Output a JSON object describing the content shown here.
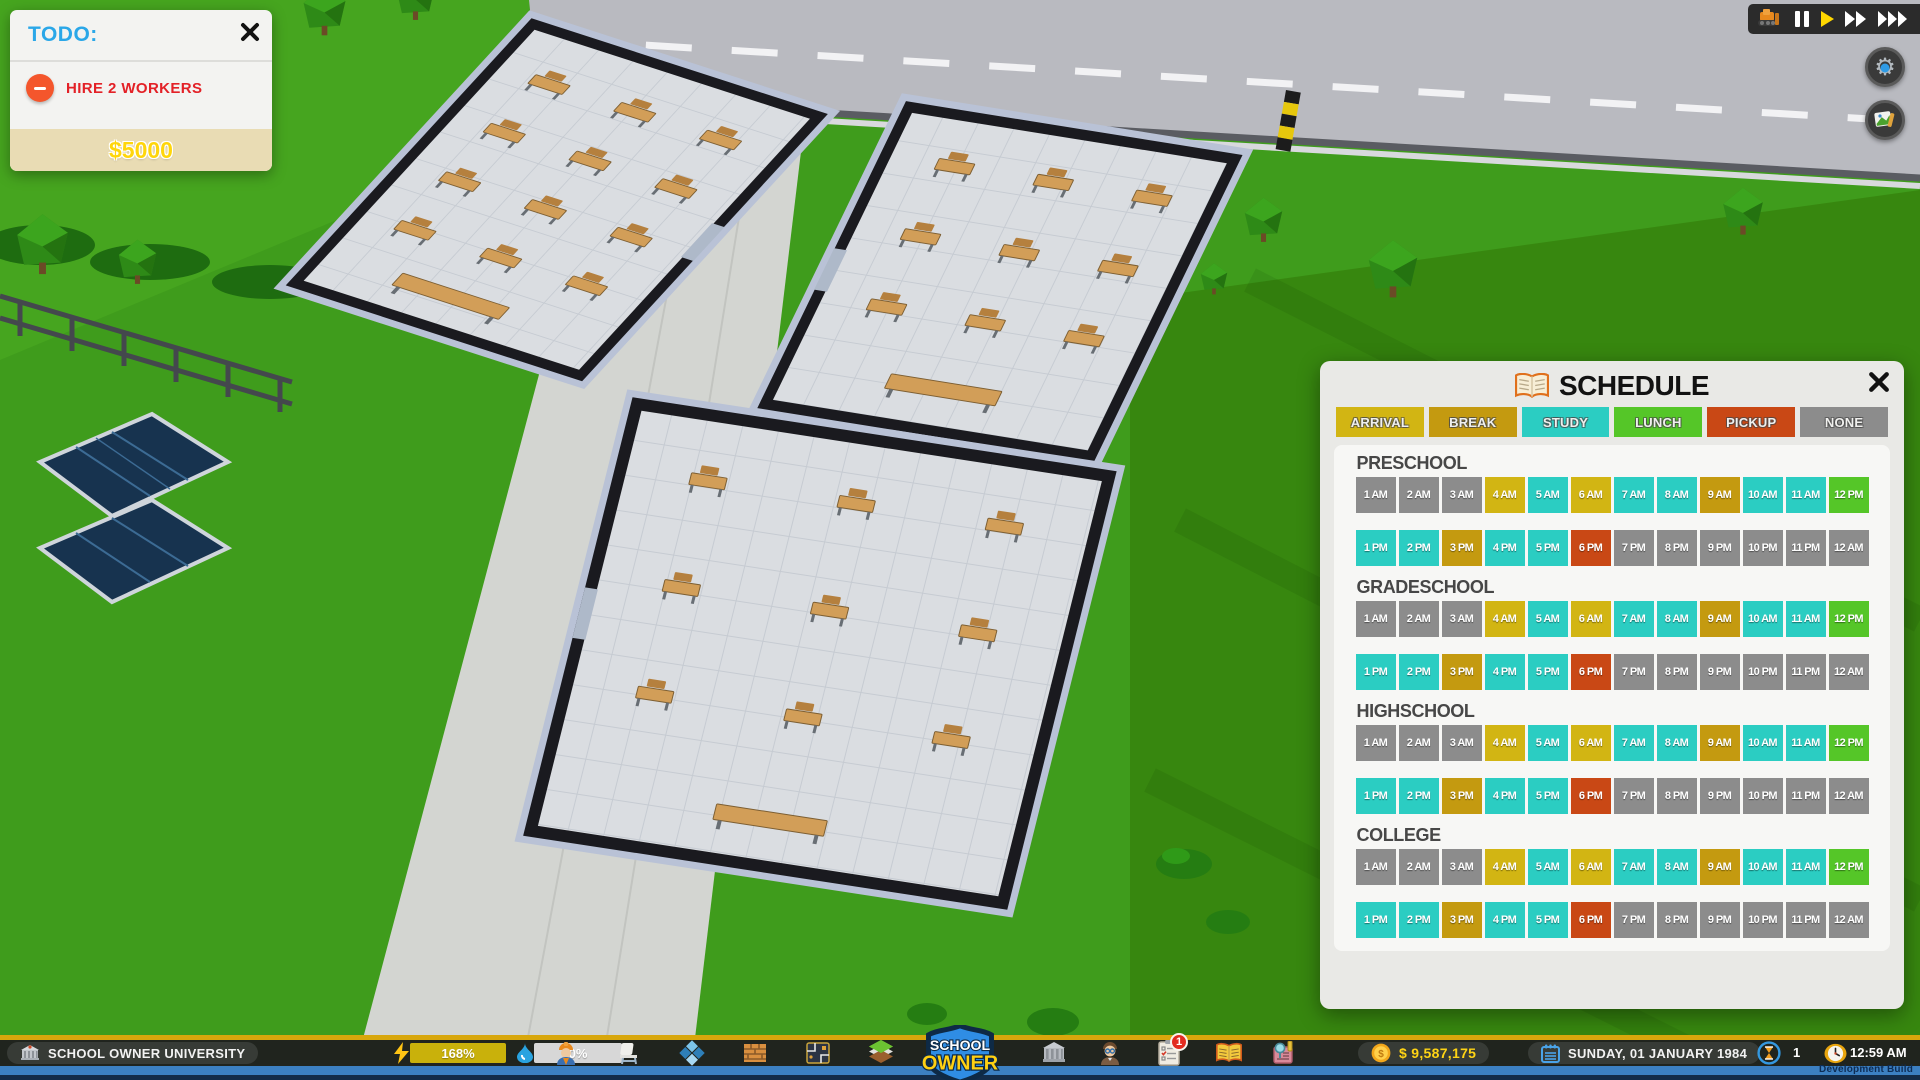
{
  "todo_panel": {
    "title": "TODO:",
    "task": "HIRE 2 WORKERS",
    "reward": "$5000"
  },
  "schedule_panel": {
    "title": "SCHEDULE",
    "legend": [
      {
        "id": "arrival",
        "label": "ARRIVAL",
        "color": "#d2b513"
      },
      {
        "id": "break",
        "label": "BREAK",
        "color": "#c49a10"
      },
      {
        "id": "study",
        "label": "STUDY",
        "color": "#2bcdc2"
      },
      {
        "id": "lunch",
        "label": "LUNCH",
        "color": "#55c628"
      },
      {
        "id": "pickup",
        "label": "PICKUP",
        "color": "#c94815"
      },
      {
        "id": "none",
        "label": "NONE",
        "color": "#8c8c8c"
      }
    ],
    "hours_row1": [
      "1 AM",
      "2 AM",
      "3 AM",
      "4 AM",
      "5 AM",
      "6 AM",
      "7 AM",
      "8 AM",
      "9 AM",
      "10 AM",
      "11 AM",
      "12 PM"
    ],
    "hours_row2": [
      "1 PM",
      "2 PM",
      "3 PM",
      "4 PM",
      "5 PM",
      "6 PM",
      "7 PM",
      "8 PM",
      "9 PM",
      "10 PM",
      "11 PM",
      "12 AM"
    ],
    "sections": [
      {
        "name": "PRESCHOOL",
        "row1": [
          "none",
          "none",
          "none",
          "arrival",
          "study",
          "arrival",
          "study",
          "study",
          "break",
          "study",
          "study",
          "lunch"
        ],
        "row2": [
          "study",
          "study",
          "break",
          "study",
          "study",
          "pickup",
          "none",
          "none",
          "none",
          "none",
          "none",
          "none"
        ]
      },
      {
        "name": "GRADESCHOOL",
        "row1": [
          "none",
          "none",
          "none",
          "arrival",
          "study",
          "arrival",
          "study",
          "study",
          "break",
          "study",
          "study",
          "lunch"
        ],
        "row2": [
          "study",
          "study",
          "break",
          "study",
          "study",
          "pickup",
          "none",
          "none",
          "none",
          "none",
          "none",
          "none"
        ]
      },
      {
        "name": "HIGHSCHOOL",
        "row1": [
          "none",
          "none",
          "none",
          "arrival",
          "study",
          "arrival",
          "study",
          "study",
          "break",
          "study",
          "study",
          "lunch"
        ],
        "row2": [
          "study",
          "study",
          "break",
          "study",
          "study",
          "pickup",
          "none",
          "none",
          "none",
          "none",
          "none",
          "none"
        ]
      },
      {
        "name": "COLLEGE",
        "row1": [
          "none",
          "none",
          "none",
          "arrival",
          "study",
          "arrival",
          "study",
          "study",
          "break",
          "study",
          "study",
          "lunch"
        ],
        "row2": [
          "study",
          "study",
          "break",
          "study",
          "study",
          "pickup",
          "none",
          "none",
          "none",
          "none",
          "none",
          "none"
        ]
      }
    ]
  },
  "bottom_bar": {
    "school_name": "SCHOOL OWNER UNIVERSITY",
    "power_pct": "168%",
    "water_pct": "0%",
    "logo_line1": "SCHOOL",
    "logo_line2": "OWNER",
    "notification_count": "1",
    "money": "$ 9,587,175",
    "date": "SUNDAY, 01 JANUARY 1984",
    "speed_value": "1",
    "time": "12:59 AM",
    "dev_build": "Development Build",
    "colors": {
      "gold_strip": "#d8a70c",
      "blue_strip": "#3c80c2",
      "money_text": "#ffd414",
      "power_bar": "#c9b10b",
      "water_bar": "#d7d7d7"
    }
  }
}
